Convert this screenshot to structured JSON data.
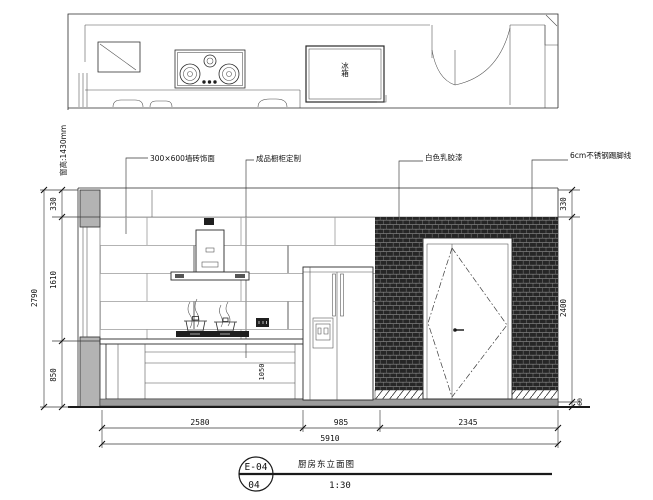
{
  "plan": {
    "fridge_label": "冰箱",
    "window_note": "窗高:1430mm"
  },
  "callouts": {
    "tile": "300×600墙砖饰面",
    "cabinet": "成品橱柜定制",
    "paint": "白色乳胶漆",
    "skirting": "6cm不锈钢踢脚线"
  },
  "dimensions": {
    "left_overall": "2790",
    "left_segments": [
      "330",
      "1610",
      "850"
    ],
    "right_segments": [
      "330",
      "2400",
      "60"
    ],
    "bottom_segments": [
      "2580",
      "985",
      "2345"
    ],
    "bottom_overall": "5910",
    "cabinet_note": "1050"
  },
  "title_block": {
    "code": "E-04",
    "sheet": "04",
    "title": "厨房东立面图",
    "scale": "1:30"
  },
  "colors": {
    "line": "#2a2a2a",
    "wall_fill": "#b3b3b3",
    "hatch_dark": "#262626",
    "background": "#ffffff"
  }
}
